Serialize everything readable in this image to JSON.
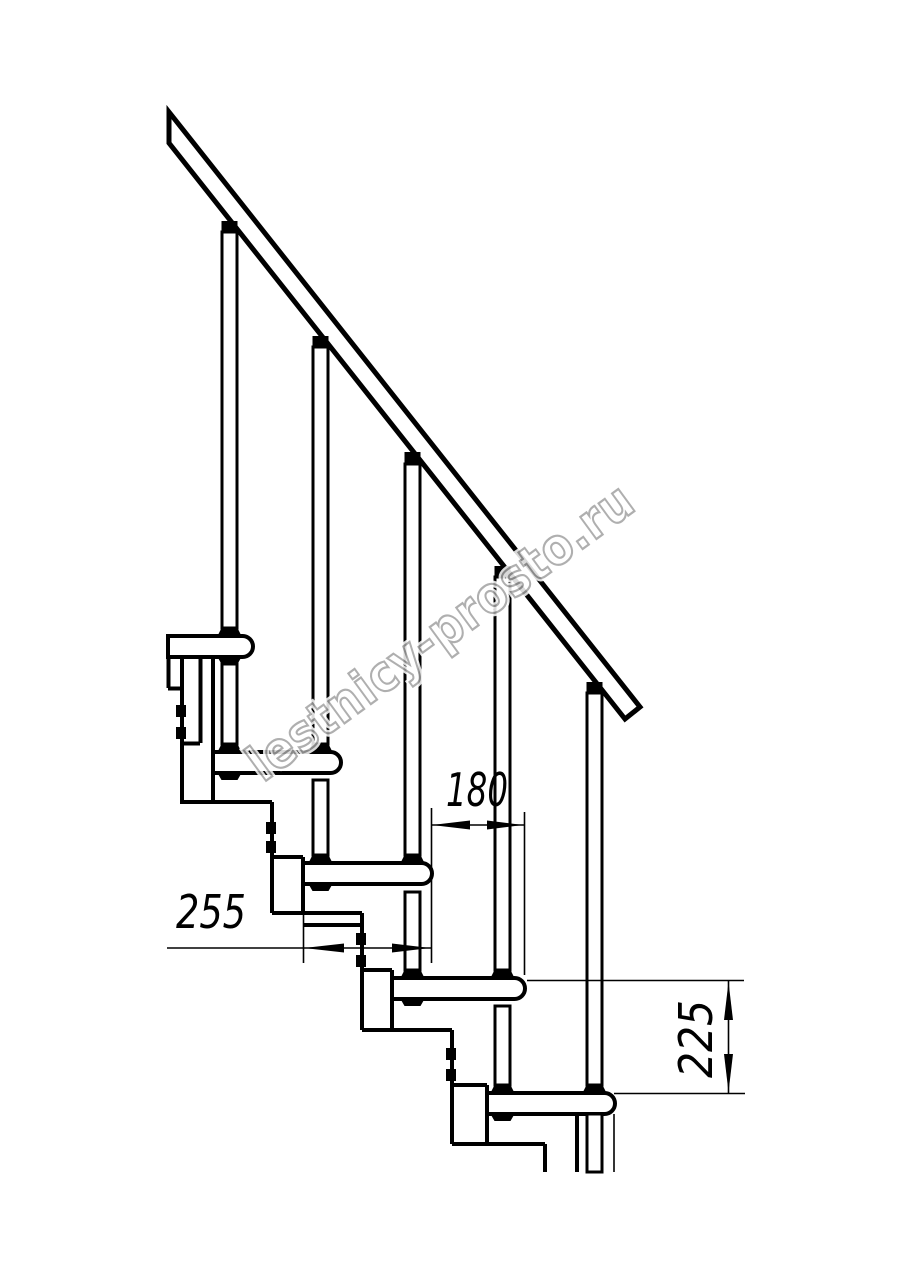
{
  "page": {
    "background": "#ffffff",
    "line_color": "#000000"
  },
  "watermark": {
    "text": "lestnicy-prosto.ru",
    "color": "#a2a2a2"
  },
  "dimensions": [
    {
      "id": "dim-horizontal-going",
      "value": "180"
    },
    {
      "id": "dim-horizontal-depth",
      "value": "255"
    },
    {
      "id": "dim-vertical-rise",
      "value": "225"
    }
  ]
}
